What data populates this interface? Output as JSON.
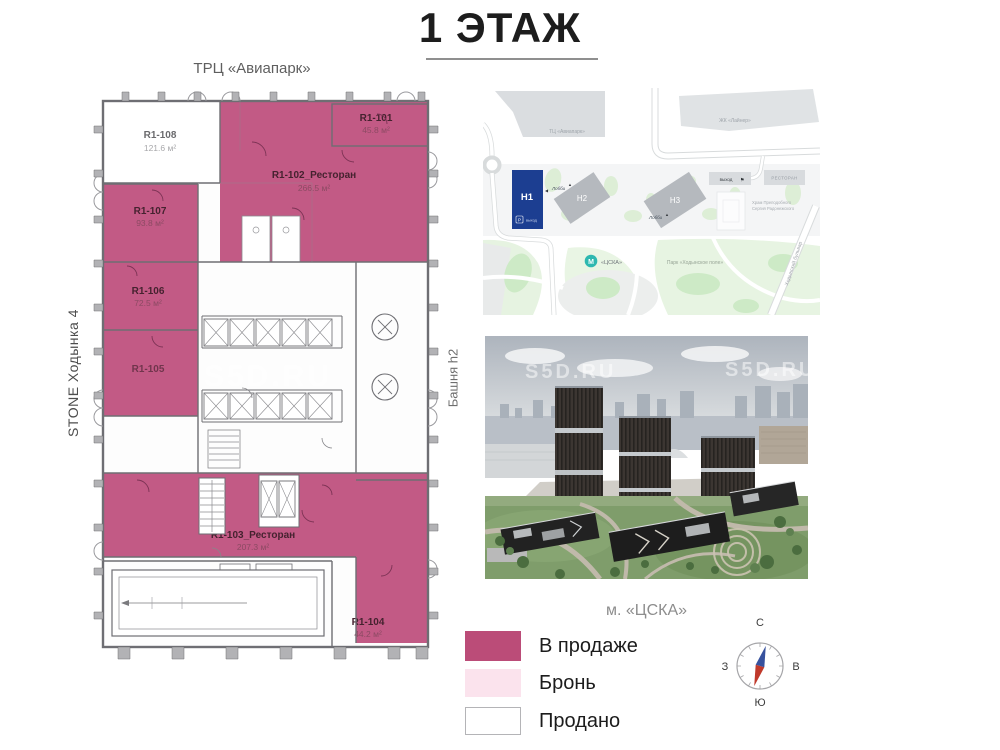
{
  "title": "1 ЭТАЖ",
  "plan": {
    "top_label": "ТРЦ «Авиапарк»",
    "left_label": "STONE Ходынка 4",
    "right_label": "Башня h2",
    "watermark": "S5D.RU",
    "units": [
      {
        "id": "R1-108",
        "area": "121.6 м²",
        "status": "Продано"
      },
      {
        "id": "R1-101",
        "area": "45.8 м²",
        "status": "В продаже"
      },
      {
        "id": "R1-102_Ресторан",
        "area": "266.5 м²",
        "status": "В продаже"
      },
      {
        "id": "R1-107",
        "area": "93.8 м²",
        "status": "В продаже"
      },
      {
        "id": "R1-106",
        "area": "72.5 м²",
        "status": "В продаже"
      },
      {
        "id": "R1-105",
        "area": "",
        "status": "В продаже"
      },
      {
        "id": "R1-103_Ресторан",
        "area": "207.3 м²",
        "status": "В продаже"
      },
      {
        "id": "R1-104",
        "area": "44.2 м²",
        "status": "В продаже"
      }
    ]
  },
  "map": {
    "aviapark": "ТЦ «Авиапарк»",
    "liner": "ЖК «Лайнер»",
    "h1": "Н1",
    "h2": "Н2",
    "h3": "Н3",
    "h1_parking": "Р",
    "h1_exit": "выход",
    "lobby1": "Лобби",
    "lobby2": "Лобби",
    "exit": "выход",
    "restaurant": "РЕСТОРАН",
    "church_line1": "Храм Преподобного",
    "church_line2": "Сергия Радонежского",
    "metro_letter": "М",
    "metro": "«ЦСКА»",
    "park": "Парк «Ходынское поле»",
    "street": "Ходынский бульвар"
  },
  "photo": {
    "watermark_left": "S5D.RU",
    "watermark_right": "S5D.RU"
  },
  "footer": {
    "metro_label": "м. «ЦСКА»",
    "legend": [
      {
        "label": "В продаже",
        "color": "#bb4c78"
      },
      {
        "label": "Бронь",
        "color": "#fbe3ed"
      },
      {
        "label": "Продано",
        "color": "#ffffff"
      }
    ],
    "compass": {
      "n": "С",
      "s": "Ю",
      "w": "З",
      "e": "В"
    }
  },
  "icons": {
    "arrow_left": "◀",
    "arrow_up": "▲",
    "flag": "⚑"
  },
  "colors": {
    "for_sale": "#c25a85",
    "h1_blue": "#1c3e91",
    "metro_teal": "#2eb8b0"
  }
}
